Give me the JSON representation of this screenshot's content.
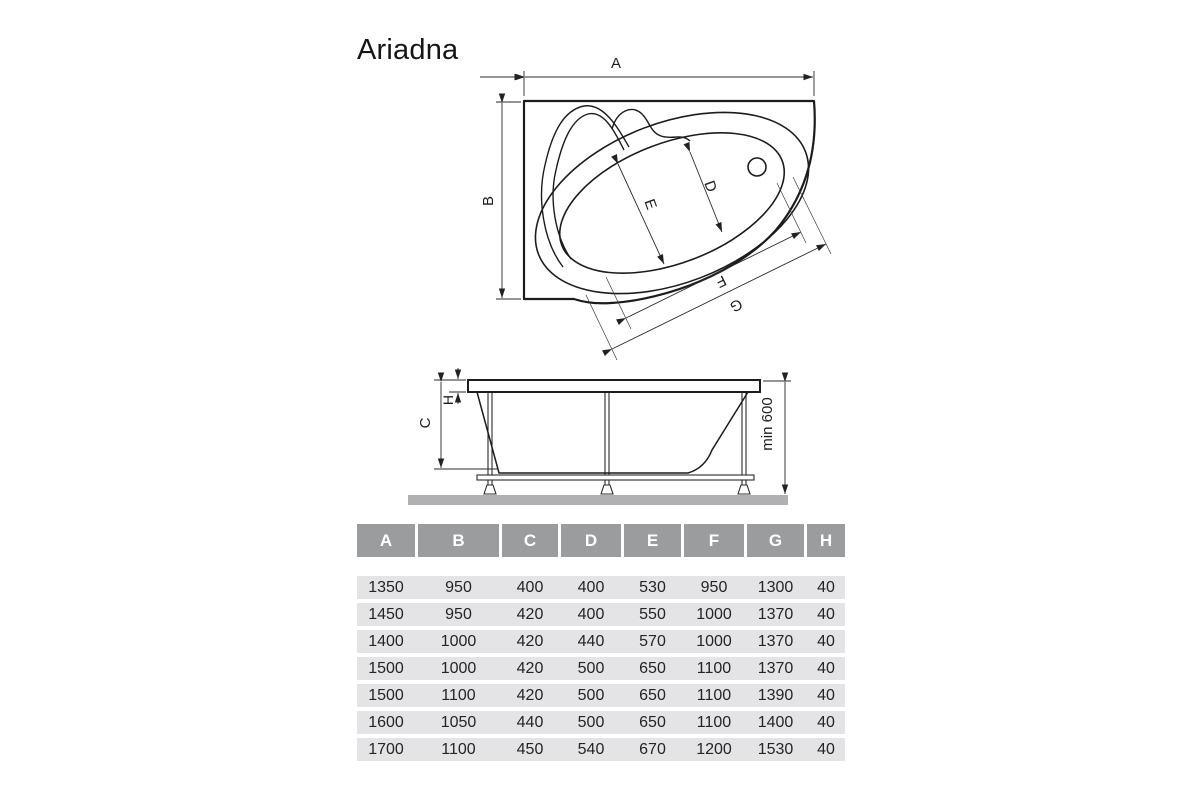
{
  "page": {
    "title": "Ariadna"
  },
  "top_view": {
    "dim_a": "A",
    "dim_b": "B",
    "dim_d": "D",
    "dim_e": "E",
    "dim_f": "F",
    "dim_g": "G"
  },
  "side_view": {
    "dim_c": "C",
    "dim_h": "H",
    "dim_min_height": "min 600"
  },
  "table": {
    "columns": [
      "A",
      "B",
      "C",
      "D",
      "E",
      "F",
      "G",
      "H"
    ],
    "rows": [
      [
        "1350",
        "950",
        "400",
        "400",
        "530",
        "950",
        "1300",
        "40"
      ],
      [
        "1450",
        "950",
        "420",
        "400",
        "550",
        "1000",
        "1370",
        "40"
      ],
      [
        "1400",
        "1000",
        "420",
        "440",
        "570",
        "1000",
        "1370",
        "40"
      ],
      [
        "1500",
        "1000",
        "420",
        "500",
        "650",
        "1100",
        "1370",
        "40"
      ],
      [
        "1500",
        "1100",
        "420",
        "500",
        "650",
        "1100",
        "1390",
        "40"
      ],
      [
        "1600",
        "1050",
        "440",
        "500",
        "650",
        "1100",
        "1400",
        "40"
      ],
      [
        "1700",
        "1100",
        "450",
        "540",
        "670",
        "1200",
        "1530",
        "40"
      ]
    ]
  },
  "colors": {
    "header_bg": "#9b9c9e",
    "header_text": "#ffffff",
    "row_bg": "#e4e4e6",
    "line": "#1d1d1f",
    "ground": "#b0b0b3"
  }
}
